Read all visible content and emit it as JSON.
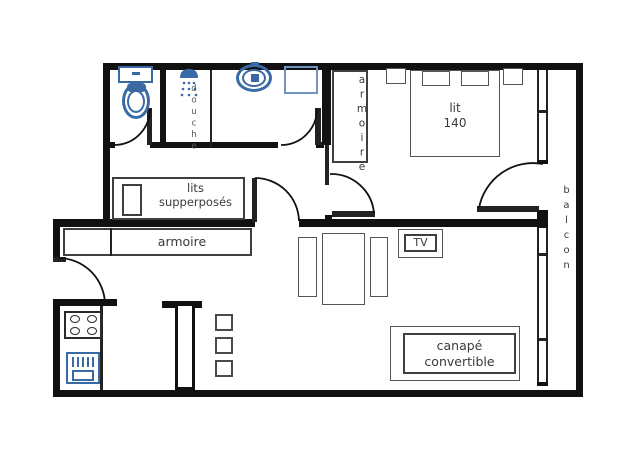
{
  "plan_title": "apartment-floor-plan",
  "labels": {
    "shower": "douche",
    "bedroom_wardrobe": "armoire",
    "bed_line1": "lit",
    "bed_line2": "140",
    "bunk_line1": "lits",
    "bunk_line2": "supperposés",
    "hall_wardrobe": "armoire",
    "tv": "TV",
    "balcony": "balcon",
    "sofa_line1": "canapé",
    "sofa_line2": "convertible"
  },
  "colors": {
    "wall": "#111111",
    "fixture_blue": "#3a6aa5",
    "mirror_blue": "#7193c1",
    "furniture_outline": "#3f3f3f",
    "text": "#3a3a3a",
    "background": "#ffffff"
  }
}
